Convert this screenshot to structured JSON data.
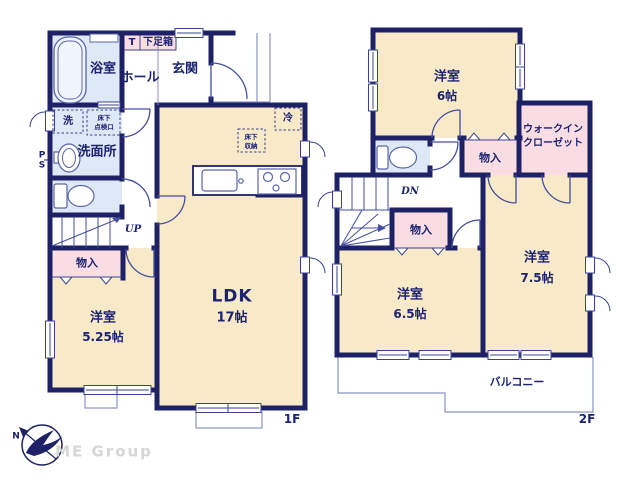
{
  "floor1": {
    "floor_label": "1F",
    "labels": {
      "bathroom": "浴室",
      "hall": "ホール",
      "entrance": "玄関",
      "shoe_t": "T",
      "shoe_box": "下足箱",
      "washer": "洗",
      "hatch_line1": "床下",
      "hatch_line2": "点検口",
      "washroom": "洗面所",
      "ps_line1": "P",
      "ps_line2": "S",
      "stairs_up": "UP",
      "closet": "物入",
      "western_room": "洋室",
      "western_room_size": "5.25帖",
      "ldk": "LDK",
      "ldk_size": "17帖",
      "fridge": "冷",
      "floor_storage_line1": "床下",
      "floor_storage_line2": "収納"
    }
  },
  "floor2": {
    "floor_label": "2F",
    "labels": {
      "western_room_6": "洋室",
      "western_room_6_size": "6帖",
      "wic_line1": "ウォークイン",
      "wic_line2": "クローゼット",
      "closet_upper": "物入",
      "stairs_down": "DN",
      "closet_lower": "物入",
      "western_room_65": "洋室",
      "western_room_65_size": "6.5帖",
      "western_room_75": "洋室",
      "western_room_75_size": "7.5帖",
      "balcony": "バルコニー"
    }
  },
  "logo": {
    "company": "ME Group",
    "compass_north": "N"
  },
  "colors": {
    "wall_navy": "#1e2166",
    "room_cream": "#f8e9c9",
    "wet_room_blue": "#dde9f6",
    "closet_pink": "#f9dde2",
    "text_navy": "#1c2370",
    "logo_gray": "#d6d6d6"
  }
}
